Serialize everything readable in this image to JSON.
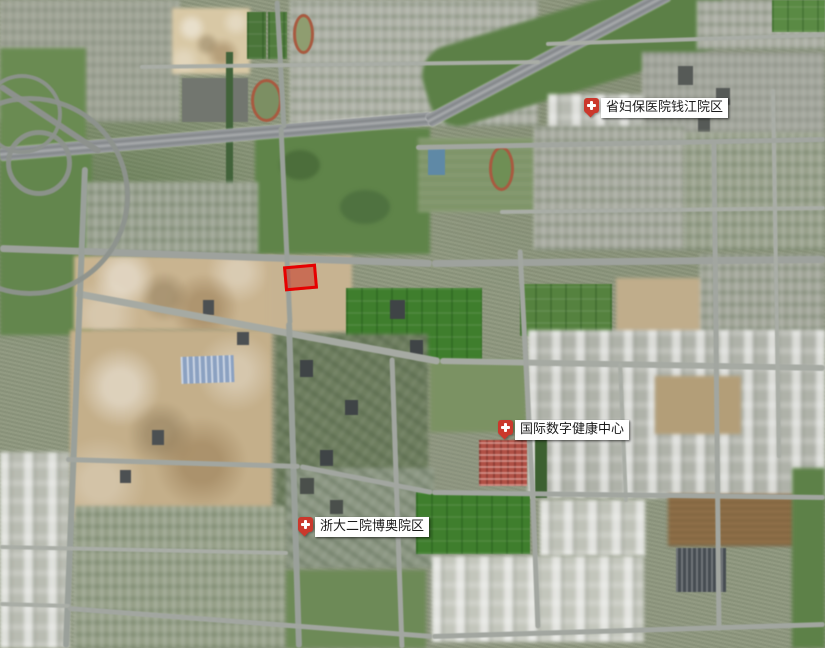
{
  "map": {
    "base_color": "#8e977e",
    "patches": [
      {
        "t": "urban",
        "x": 0,
        "y": 0,
        "w": 180,
        "h": 122,
        "c": "#9da293"
      },
      {
        "t": "green",
        "x": 0,
        "y": 48,
        "w": 86,
        "h": 100,
        "c": "#6a8b52"
      },
      {
        "t": "construction",
        "x": 172,
        "y": 8,
        "w": 78,
        "h": 66,
        "c": "#d8c8a5"
      },
      {
        "t": "field",
        "x": 247,
        "y": 12,
        "w": 19,
        "h": 47,
        "c": "#4a7539"
      },
      {
        "t": "field",
        "x": 268,
        "y": 12,
        "w": 19,
        "h": 47,
        "c": "#517c3e"
      },
      {
        "t": "res",
        "x": 290,
        "y": 0,
        "w": 248,
        "h": 126,
        "c": "#aeb1a6"
      },
      {
        "t": "dark",
        "x": 182,
        "y": 78,
        "w": 66,
        "h": 44,
        "c": "#72766f"
      },
      {
        "t": "track",
        "x": 251,
        "y": 79,
        "w": 31,
        "h": 43,
        "c": "#7c8f63"
      },
      {
        "t": "track",
        "x": 293,
        "y": 14,
        "w": 21,
        "h": 40,
        "c": "#8f9d70"
      },
      {
        "t": "green",
        "x": 420,
        "y": 8,
        "w": 310,
        "h": 82,
        "c": "#5c8047",
        "r": -17,
        "br": "30px"
      },
      {
        "t": "res",
        "x": 697,
        "y": 0,
        "w": 128,
        "h": 50,
        "c": "#abaea3"
      },
      {
        "t": "field",
        "x": 772,
        "y": 0,
        "w": 53,
        "h": 32,
        "c": "#5a8a44"
      },
      {
        "t": "urban",
        "x": 642,
        "y": 52,
        "w": 183,
        "h": 92,
        "c": "#a2a59b"
      },
      {
        "t": "dark",
        "x": 678,
        "y": 66,
        "w": 15,
        "h": 19,
        "c": "#565a57"
      },
      {
        "t": "dark",
        "x": 716,
        "y": 88,
        "w": 14,
        "h": 17,
        "c": "#565a57"
      },
      {
        "t": "dark",
        "x": 698,
        "y": 118,
        "w": 12,
        "h": 14,
        "c": "#565a57"
      },
      {
        "t": "industrial",
        "x": 548,
        "y": 94,
        "w": 96,
        "h": 44,
        "c": "#b6b9b0"
      },
      {
        "t": "canal",
        "x": 226,
        "y": 52,
        "w": 7,
        "h": 200,
        "c": "#42633a"
      },
      {
        "t": "green",
        "x": 0,
        "y": 150,
        "w": 92,
        "h": 185,
        "c": "#63864d"
      },
      {
        "t": "green",
        "x": 255,
        "y": 128,
        "w": 175,
        "h": 126,
        "c": "#5f8449"
      },
      {
        "t": "tree",
        "x": 280,
        "y": 150,
        "w": 40,
        "h": 30,
        "c": "#4c6e3b",
        "br": "50%"
      },
      {
        "t": "tree",
        "x": 340,
        "y": 190,
        "w": 50,
        "h": 34,
        "c": "#4f7240",
        "br": "50%"
      },
      {
        "t": "res",
        "x": 86,
        "y": 182,
        "w": 172,
        "h": 72,
        "c": "#99a18f"
      },
      {
        "t": "campus",
        "x": 418,
        "y": 138,
        "w": 116,
        "h": 74,
        "c": "#7e9468"
      },
      {
        "t": "pool",
        "x": 428,
        "y": 148,
        "w": 17,
        "h": 27,
        "c": "#5f89a6"
      },
      {
        "t": "track",
        "x": 489,
        "y": 146,
        "w": 25,
        "h": 45,
        "c": "#6f8f55"
      },
      {
        "t": "res",
        "x": 534,
        "y": 126,
        "w": 150,
        "h": 124,
        "c": "#a7aa9f"
      },
      {
        "t": "res",
        "x": 684,
        "y": 132,
        "w": 141,
        "h": 118,
        "c": "#9aa28d"
      },
      {
        "t": "construction",
        "x": 74,
        "y": 256,
        "w": 200,
        "h": 74,
        "c": "#c9b490"
      },
      {
        "t": "dirt",
        "x": 268,
        "y": 256,
        "w": 84,
        "h": 76,
        "c": "#c7b391"
      },
      {
        "t": "field",
        "x": 346,
        "y": 288,
        "w": 136,
        "h": 74,
        "c": "#3f7e2d"
      },
      {
        "t": "field",
        "x": 520,
        "y": 284,
        "w": 92,
        "h": 52,
        "c": "#55823f"
      },
      {
        "t": "dirt",
        "x": 616,
        "y": 278,
        "w": 88,
        "h": 56,
        "c": "#c0ad8b"
      },
      {
        "t": "res",
        "x": 700,
        "y": 254,
        "w": 125,
        "h": 88,
        "c": "#a2a699"
      },
      {
        "t": "construction",
        "x": 70,
        "y": 330,
        "w": 202,
        "h": 190,
        "c": "#c4af8a"
      },
      {
        "t": "warehouse-blue",
        "x": 181,
        "y": 356,
        "w": 53,
        "h": 27,
        "c": "#8ba1c1",
        "r": -2
      },
      {
        "t": "dark",
        "x": 203,
        "y": 300,
        "w": 11,
        "h": 15,
        "c": "#4c5052"
      },
      {
        "t": "dark",
        "x": 237,
        "y": 332,
        "w": 12,
        "h": 13,
        "c": "#4c5052"
      },
      {
        "t": "dark",
        "x": 152,
        "y": 430,
        "w": 12,
        "h": 15,
        "c": "#4c5052"
      },
      {
        "t": "dark",
        "x": 120,
        "y": 470,
        "w": 11,
        "h": 13,
        "c": "#4c5052"
      },
      {
        "t": "urbanveg",
        "x": 276,
        "y": 334,
        "w": 152,
        "h": 182,
        "c": "#6e7e5f"
      },
      {
        "t": "dark",
        "x": 300,
        "y": 360,
        "w": 13,
        "h": 17,
        "c": "#3f4446"
      },
      {
        "t": "dark",
        "x": 345,
        "y": 400,
        "w": 13,
        "h": 15,
        "c": "#3f4446"
      },
      {
        "t": "dark",
        "x": 390,
        "y": 300,
        "w": 15,
        "h": 19,
        "c": "#3f4446"
      },
      {
        "t": "dark",
        "x": 410,
        "y": 340,
        "w": 13,
        "h": 15,
        "c": "#3f4446"
      },
      {
        "t": "dark",
        "x": 320,
        "y": 450,
        "w": 13,
        "h": 16,
        "c": "#3f4446"
      },
      {
        "t": "dark",
        "x": 370,
        "y": 490,
        "w": 12,
        "h": 14,
        "c": "#3f4446"
      },
      {
        "t": "industrial",
        "x": 528,
        "y": 330,
        "w": 297,
        "h": 168,
        "c": "#afb2a9"
      },
      {
        "t": "dirt",
        "x": 655,
        "y": 376,
        "w": 86,
        "h": 58,
        "c": "#b39e78"
      },
      {
        "t": "green",
        "x": 430,
        "y": 360,
        "w": 96,
        "h": 72,
        "c": "#7b9263"
      },
      {
        "t": "redroof",
        "x": 479,
        "y": 440,
        "w": 48,
        "h": 46,
        "c": "#b05045"
      },
      {
        "t": "treerow",
        "x": 535,
        "y": 438,
        "w": 12,
        "h": 60,
        "c": "#3c6030"
      },
      {
        "t": "industrial",
        "x": 0,
        "y": 452,
        "w": 70,
        "h": 196,
        "c": "#b9bcb2"
      },
      {
        "t": "res",
        "x": 74,
        "y": 506,
        "w": 212,
        "h": 142,
        "c": "#97a189"
      },
      {
        "t": "urbanveg",
        "x": 286,
        "y": 468,
        "w": 148,
        "h": 100,
        "c": "#8d9884"
      },
      {
        "t": "dark",
        "x": 300,
        "y": 478,
        "w": 14,
        "h": 16,
        "c": "#4a4f4b"
      },
      {
        "t": "dark",
        "x": 330,
        "y": 500,
        "w": 13,
        "h": 14,
        "c": "#4a4f4b"
      },
      {
        "t": "field",
        "x": 416,
        "y": 492,
        "w": 114,
        "h": 62,
        "c": "#3f7e2d"
      },
      {
        "t": "industrial",
        "x": 540,
        "y": 500,
        "w": 105,
        "h": 56,
        "c": "#bfc2b8"
      },
      {
        "t": "industrial",
        "x": 432,
        "y": 556,
        "w": 212,
        "h": 86,
        "c": "#c3c6bc"
      },
      {
        "t": "brownfield",
        "x": 668,
        "y": 494,
        "w": 126,
        "h": 52,
        "c": "#9a794f"
      },
      {
        "t": "solar",
        "x": 676,
        "y": 548,
        "w": 50,
        "h": 44,
        "c": "#474d52"
      },
      {
        "t": "green",
        "x": 792,
        "y": 468,
        "w": 33,
        "h": 180,
        "c": "#5d8148"
      },
      {
        "t": "green",
        "x": 286,
        "y": 570,
        "w": 140,
        "h": 78,
        "c": "#6d8a57"
      }
    ],
    "roads": [
      {
        "x1": 0,
        "y1": 154,
        "x2": 432,
        "y2": 118,
        "w": 13,
        "c": "#83878a",
        "k": "hw"
      },
      {
        "x1": 428,
        "y1": 121,
        "x2": 668,
        "y2": -6,
        "w": 13,
        "c": "#83878a",
        "k": "hw"
      },
      {
        "x1": 0,
        "y1": 86,
        "x2": 100,
        "y2": 152,
        "w": 6,
        "c": "#8d918d"
      },
      {
        "x1": 0,
        "y1": 248,
        "x2": 432,
        "y2": 263,
        "w": 7,
        "c": "#9ea29d"
      },
      {
        "x1": 432,
        "y1": 263,
        "x2": 825,
        "y2": 259,
        "w": 7,
        "c": "#9ea29d"
      },
      {
        "x1": 76,
        "y1": 293,
        "x2": 440,
        "y2": 361,
        "w": 7,
        "c": "#a6aaa3"
      },
      {
        "x1": 440,
        "y1": 361,
        "x2": 825,
        "y2": 368,
        "w": 6,
        "c": "#a6aaa3"
      },
      {
        "x1": 85,
        "y1": 167,
        "x2": 66,
        "y2": 648,
        "w": 6,
        "c": "#9aa09a"
      },
      {
        "x1": 277,
        "y1": 0,
        "x2": 284,
        "y2": 128,
        "w": 5,
        "c": "#9aa09a"
      },
      {
        "x1": 281,
        "y1": 126,
        "x2": 290,
        "y2": 324,
        "w": 5,
        "c": "#9aa09a"
      },
      {
        "x1": 289,
        "y1": 322,
        "x2": 299,
        "y2": 648,
        "w": 6,
        "c": "#9aa09a"
      },
      {
        "x1": 520,
        "y1": 249,
        "x2": 533,
        "y2": 500,
        "w": 5,
        "c": "#a2a6a0"
      },
      {
        "x1": 533,
        "y1": 498,
        "x2": 538,
        "y2": 628,
        "w": 5,
        "c": "#a2a6a0"
      },
      {
        "x1": 714,
        "y1": 141,
        "x2": 719,
        "y2": 630,
        "w": 5,
        "c": "#a2a6a0"
      },
      {
        "x1": 773,
        "y1": 89,
        "x2": 779,
        "y2": 458,
        "w": 4,
        "c": "#a9ada6"
      },
      {
        "x1": 392,
        "y1": 357,
        "x2": 402,
        "y2": 648,
        "w": 5,
        "c": "#a2a6a0"
      },
      {
        "x1": 620,
        "y1": 363,
        "x2": 626,
        "y2": 502,
        "w": 4,
        "c": "#a9ada6"
      },
      {
        "x1": 416,
        "y1": 147,
        "x2": 825,
        "y2": 139,
        "w": 5,
        "c": "#a2a6a0"
      },
      {
        "x1": 500,
        "y1": 212,
        "x2": 825,
        "y2": 208,
        "w": 4,
        "c": "#a9ada6"
      },
      {
        "x1": 140,
        "y1": 67,
        "x2": 540,
        "y2": 62,
        "w": 4,
        "c": "#a9ada6"
      },
      {
        "x1": 546,
        "y1": 44,
        "x2": 825,
        "y2": 35,
        "w": 4,
        "c": "#a9ada6"
      },
      {
        "x1": 66,
        "y1": 459,
        "x2": 300,
        "y2": 466,
        "w": 5,
        "c": "#a2a6a0"
      },
      {
        "x1": 300,
        "y1": 466,
        "x2": 432,
        "y2": 492,
        "w": 5,
        "c": "#a2a6a0"
      },
      {
        "x1": 432,
        "y1": 492,
        "x2": 825,
        "y2": 497,
        "w": 5,
        "c": "#a2a6a0"
      },
      {
        "x1": 0,
        "y1": 547,
        "x2": 288,
        "y2": 553,
        "w": 4,
        "c": "#a9ada6"
      },
      {
        "x1": 0,
        "y1": 604,
        "x2": 70,
        "y2": 606,
        "w": 4,
        "c": "#a9ada6"
      },
      {
        "x1": 68,
        "y1": 608,
        "x2": 432,
        "y2": 636,
        "w": 5,
        "c": "#a2a6a0"
      },
      {
        "x1": 432,
        "y1": 636,
        "x2": 825,
        "y2": 624,
        "w": 5,
        "c": "#a2a6a0"
      }
    ],
    "arcs": [
      {
        "x": 6,
        "y": 130,
        "d": 66,
        "t": 5
      },
      {
        "x": -18,
        "y": 74,
        "d": 80,
        "t": 4
      },
      {
        "x": -70,
        "y": 96,
        "d": 200,
        "t": 5
      }
    ]
  },
  "parcel": {
    "x": 284,
    "y": 265,
    "w": 33,
    "h": 25,
    "rot": -5,
    "stroke": "#e60000",
    "fill": "rgba(201,44,28,0.5)"
  },
  "markers": [
    {
      "label": "省妇保医院钱江院区",
      "x": 584,
      "y": 98
    },
    {
      "label": "国际数字健康中心",
      "x": 498,
      "y": 420
    },
    {
      "label": "浙大二院博奥院区",
      "x": 298,
      "y": 517
    }
  ],
  "colors": {
    "marker_red": "#cb382c",
    "marker_cross": "#ffffff",
    "label_bg": "#ffffff",
    "label_text": "#1a1a1a",
    "parcel_red": "#e60000"
  }
}
